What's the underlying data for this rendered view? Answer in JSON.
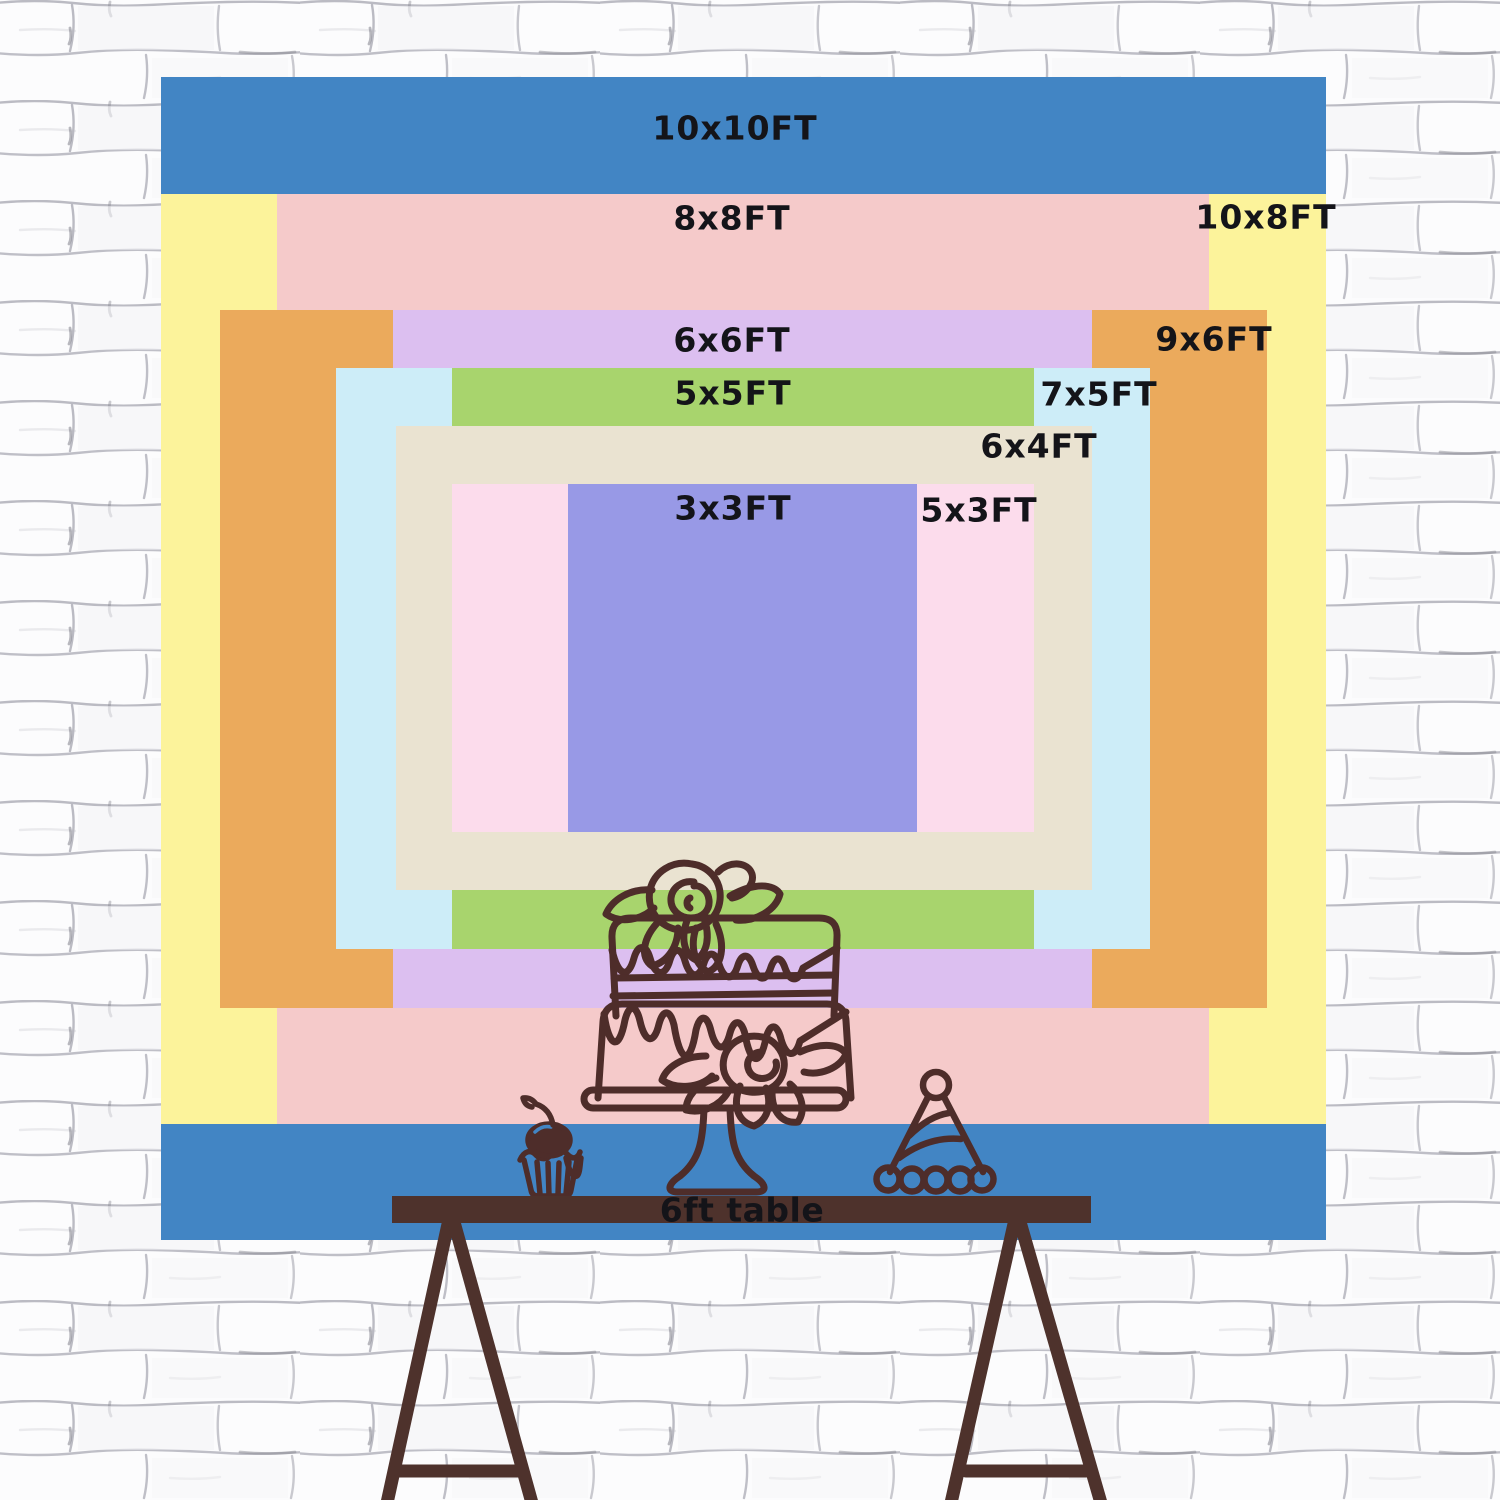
{
  "chart_data": {
    "type": "nested-size-comparison",
    "unit": "FT",
    "title": "Backdrop size chart with 6ft table for scale",
    "sizes": [
      {
        "id": "10x10",
        "label": "10x10FT",
        "width_ft": 10,
        "height_ft": 10,
        "color": "#4285c4"
      },
      {
        "id": "10x8",
        "label": "10x8FT",
        "width_ft": 10,
        "height_ft": 8,
        "color": "#fcf39b"
      },
      {
        "id": "8x8",
        "label": "8x8FT",
        "width_ft": 8,
        "height_ft": 8,
        "color": "#f5caca"
      },
      {
        "id": "9x6",
        "label": "9x6FT",
        "width_ft": 9,
        "height_ft": 6,
        "color": "#ebaa5c"
      },
      {
        "id": "6x6",
        "label": "6x6FT",
        "width_ft": 6,
        "height_ft": 6,
        "color": "#dcbff0"
      },
      {
        "id": "7x5",
        "label": "7x5FT",
        "width_ft": 7,
        "height_ft": 5,
        "color": "#cdedf8"
      },
      {
        "id": "5x5",
        "label": "5x5FT",
        "width_ft": 5,
        "height_ft": 5,
        "color": "#a8d46d"
      },
      {
        "id": "6x4",
        "label": "6x4FT",
        "width_ft": 6,
        "height_ft": 4,
        "color": "#eae3d1"
      },
      {
        "id": "5x3",
        "label": "5x3FT",
        "width_ft": 5,
        "height_ft": 3,
        "color": "#fcdcec"
      },
      {
        "id": "3x3",
        "label": "3x3FT",
        "width_ft": 3,
        "height_ft": 3,
        "color": "#9899e6"
      }
    ]
  },
  "table": {
    "label": "6ft table",
    "color": "#4e322c"
  },
  "artwork": {
    "line_color": "#4e2d2a",
    "items": [
      "cake-icon",
      "cupcake-icon",
      "party-hat-icon"
    ]
  },
  "wall": {
    "background": "#fcfcfd",
    "line_color": "#b4b4bd",
    "accent_line_color": "#80808a"
  },
  "text_color": "#141419"
}
